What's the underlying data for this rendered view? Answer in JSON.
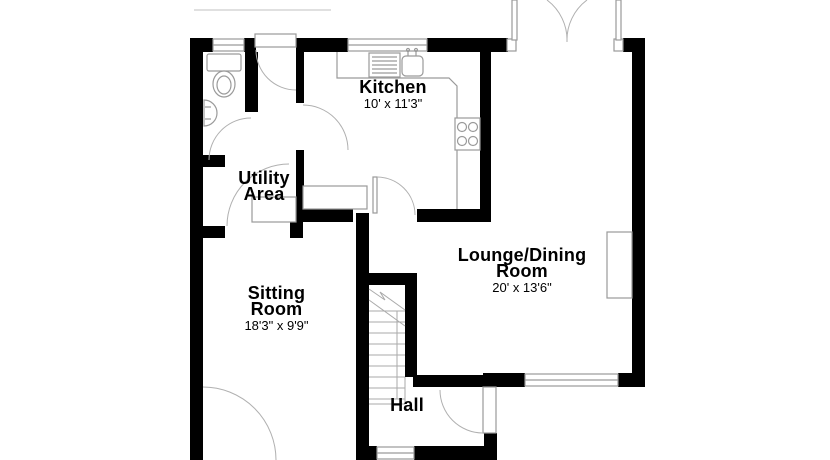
{
  "plan_type": "ground-floor floorplan",
  "colors": {
    "wall": "#000000",
    "fixture_outline": "#9a9a9a",
    "door_arc": "#b0b0b0",
    "background": "#ffffff",
    "text": "#000000"
  },
  "rooms": {
    "kitchen": {
      "name": "Kitchen",
      "dims": "10' x 11'3\""
    },
    "utility": {
      "name_line1": "Utility",
      "name_line2": "Area"
    },
    "sitting": {
      "name_line1": "Sitting",
      "name_line2": "Room",
      "dims": "18'3\" x 9'9\""
    },
    "lounge": {
      "name_line1": "Lounge/Dining",
      "name_line2": "Room",
      "dims": "20' x 13'6\""
    },
    "hall": {
      "name": "Hall"
    }
  },
  "fixtures": [
    "toilet",
    "wash-basin",
    "kitchen-sink",
    "hob",
    "worktop",
    "stairs",
    "chimney-breast"
  ],
  "openings": {
    "windows": [
      "wc-window",
      "kitchen-window",
      "lounge-south-window",
      "hall-south-window"
    ],
    "doors": [
      "french-doors",
      "back-door",
      "wc-door",
      "utility-kitchen-door",
      "kitchen-lounge-door",
      "utility-sitting-door",
      "front-door",
      "sitting-room-door"
    ]
  }
}
